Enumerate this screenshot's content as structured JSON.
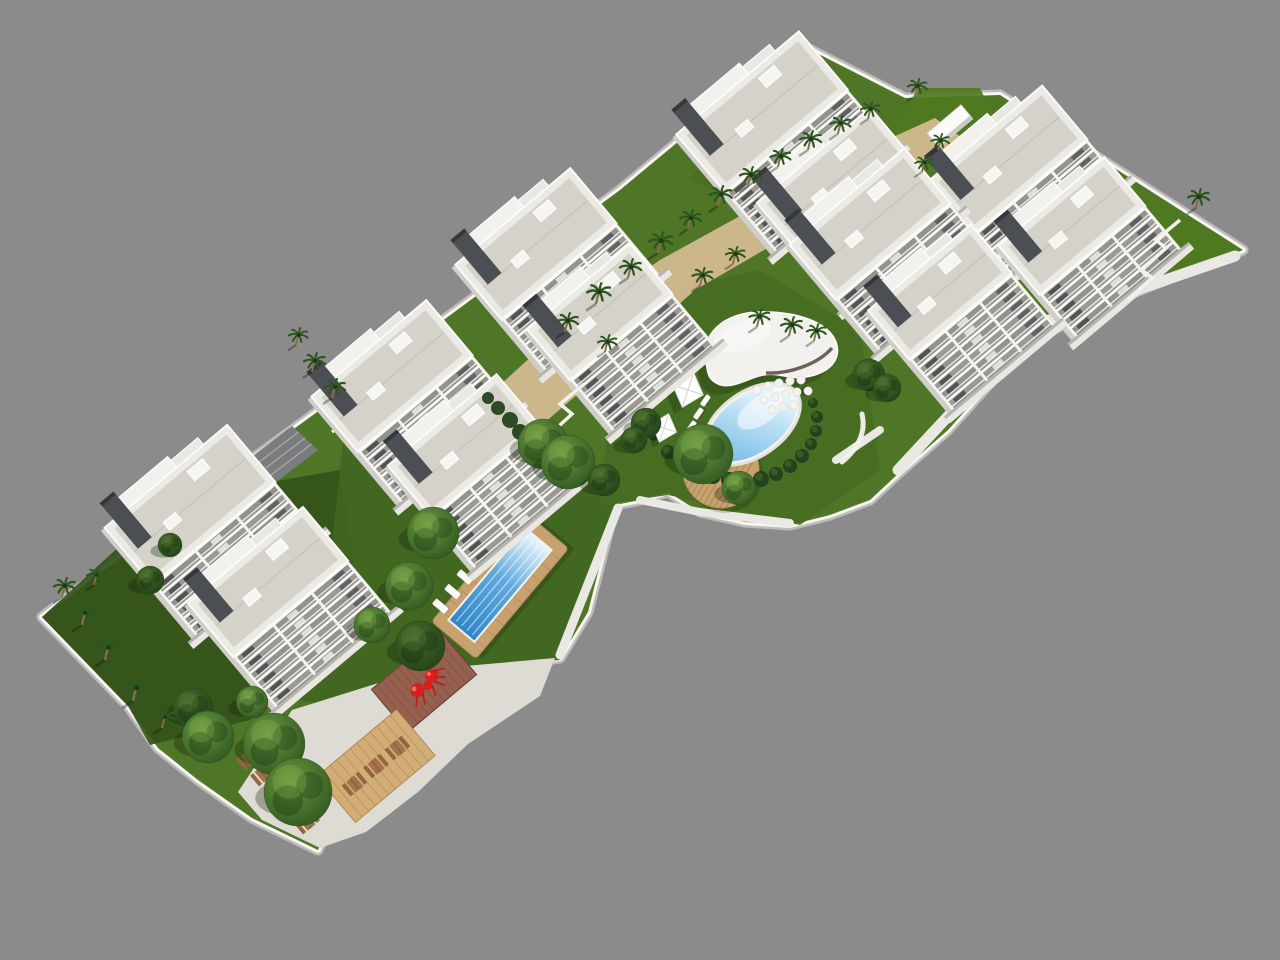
{
  "palette": {
    "bg": "#8b8b8b",
    "plotBase": "#e7e5e0",
    "wallTop": "#f6f5f1",
    "wallSide": "#bdbcb8",
    "lawnBase": "#49701f",
    "lawnDark": "#33531a",
    "lawnMid": "#41661f",
    "lawnAmenity": "#456d22",
    "lawnBright": "#4f7a1f",
    "sand": "#d2ba8e",
    "plaza": "#dddbd3",
    "walkway": "#e9e8e3",
    "ramp": "#6f7072",
    "ramp2": "#7b7c7e",
    "deckWood": "#c7a26f",
    "platformWood": "#d2ad76",
    "poolDeep": "#2e86c8",
    "poolLight": "#eaf7fd",
    "coping": "#f4f2ee",
    "hedge": "#24421c",
    "treeEdge": "#2f5420",
    "treeCore": "#6a9a3f",
    "palmFrond": "#2e5621",
    "trunk": "#8a6b4a",
    "red": "#d81f1f",
    "redDark": "#c01818",
    "paver": "#96604f",
    "facadeRecess": "#97968f",
    "sideShade": "#cfcec9",
    "roofTop": "#eceae5",
    "roofGravel": "#d5d2c9",
    "core": "#4b4e52",
    "pavement": "#e8e7e2",
    "boxWhite": "#fafaf7",
    "tableWood": "#a3714a",
    "benchWood": "#946540",
    "umbrella": "#fdfdfc"
  },
  "scene": {
    "canvas": {
      "w": 1280,
      "h": 960
    },
    "plot_outline": [
      [
        42,
        617
      ],
      [
        240,
        468
      ],
      [
        430,
        330
      ],
      [
        620,
        190
      ],
      [
        755,
        78
      ],
      [
        795,
        42
      ],
      [
        905,
        98
      ],
      [
        1000,
        95
      ],
      [
        1243,
        250
      ],
      [
        1120,
        298
      ],
      [
        1052,
        330
      ],
      [
        1000,
        372
      ],
      [
        948,
        430
      ],
      [
        900,
        472
      ],
      [
        870,
        500
      ],
      [
        830,
        515
      ],
      [
        790,
        525
      ],
      [
        745,
        522
      ],
      [
        700,
        512
      ],
      [
        668,
        492
      ],
      [
        640,
        500
      ],
      [
        615,
        505
      ],
      [
        588,
        612
      ],
      [
        560,
        658
      ],
      [
        423,
        675
      ],
      [
        383,
        715
      ],
      [
        358,
        782
      ],
      [
        332,
        818
      ],
      [
        318,
        850
      ],
      [
        252,
        818
      ],
      [
        198,
        780
      ],
      [
        158,
        748
      ],
      [
        128,
        706
      ]
    ],
    "lawn_patches": [
      {
        "pts": [
          [
            42,
            617
          ],
          [
            170,
            500
          ],
          [
            340,
            470
          ],
          [
            360,
            600
          ],
          [
            250,
            720
          ],
          [
            150,
            745
          ],
          [
            128,
            706
          ]
        ],
        "key": "lawnDark"
      },
      {
        "pts": [
          [
            330,
            560
          ],
          [
            350,
            380
          ],
          [
            520,
            430
          ],
          [
            620,
            500
          ],
          [
            560,
            660
          ],
          [
            430,
            672
          ],
          [
            383,
            715
          ],
          [
            300,
            700
          ]
        ],
        "key": "lawnMid"
      },
      {
        "pts": [
          [
            600,
            505
          ],
          [
            620,
            300
          ],
          [
            760,
            270
          ],
          [
            860,
            330
          ],
          [
            880,
            470
          ],
          [
            800,
            525
          ],
          [
            668,
            495
          ]
        ],
        "key": "lawnAmenity"
      },
      {
        "pts": [
          [
            940,
            300
          ],
          [
            990,
            185
          ],
          [
            1010,
            110
          ],
          [
            1238,
            248
          ],
          [
            1120,
            300
          ],
          [
            1046,
            332
          ],
          [
            996,
            368
          ],
          [
            950,
            340
          ]
        ],
        "key": "lawnBright"
      },
      {
        "pts": [
          [
            690,
            180
          ],
          [
            730,
            120
          ],
          [
            762,
            96
          ],
          [
            768,
            150
          ],
          [
            726,
            196
          ]
        ],
        "key": "lawnBase"
      },
      {
        "pts": [
          [
            880,
            150
          ],
          [
            920,
            88
          ],
          [
            980,
            88
          ],
          [
            1000,
            130
          ],
          [
            940,
            172
          ]
        ],
        "key": "lawnBright"
      }
    ],
    "sand_path": [
      [
        475,
        408
      ],
      [
        560,
        330
      ],
      [
        660,
        260
      ],
      [
        760,
        205
      ],
      [
        860,
        152
      ],
      [
        935,
        118
      ],
      [
        965,
        140
      ],
      [
        880,
        190
      ],
      [
        790,
        235
      ],
      [
        695,
        290
      ],
      [
        600,
        375
      ],
      [
        515,
        448
      ]
    ],
    "plaza": [
      [
        292,
        710
      ],
      [
        420,
        670
      ],
      [
        555,
        658
      ],
      [
        540,
        696
      ],
      [
        468,
        744
      ],
      [
        418,
        792
      ],
      [
        366,
        832
      ],
      [
        320,
        848
      ],
      [
        262,
        820
      ],
      [
        238,
        792
      ]
    ],
    "walkways": [
      {
        "d": "M 560 655 L 618 508",
        "w": 9
      },
      {
        "d": "M 470 562 L 568 468",
        "w": 10
      },
      {
        "d": "M 898 470 L 1032 326 L 1235 256",
        "w": 11
      },
      {
        "d": "M 640 500 L 700 512 L 790 523",
        "w": 8
      },
      {
        "d": "M 836 460 L 880 430",
        "w": 8
      }
    ],
    "planter_walls": [
      {
        "d": "M 150 520 L 192 488 L 214 510 L 252 482",
        "w": 3
      },
      {
        "d": "M 332 432 L 372 402 L 392 422 L 430 394",
        "w": 3
      }
    ],
    "zigzag_paths": [
      {
        "d": "M 1128 300 L 1152 278 L 1142 270 L 1166 248 L 1156 240 L 1180 220",
        "w": 3.5
      },
      {
        "d": "M 536 468 L 560 446 L 548 436 L 572 414 L 560 404 L 584 384",
        "w": 3.5
      }
    ],
    "ramps": [
      {
        "pts": [
          [
            356,
            392
          ],
          [
            418,
            344
          ],
          [
            452,
            372
          ],
          [
            390,
            420
          ]
        ],
        "key": "ramp"
      },
      {
        "pts": [
          [
            232,
            472
          ],
          [
            292,
            426
          ],
          [
            318,
            450
          ],
          [
            258,
            496
          ]
        ],
        "key": "ramp2"
      }
    ],
    "buildings": [
      {
        "x": 762,
        "y": 112,
        "w": 160,
        "d": 76,
        "floors": 7
      },
      {
        "x": 1008,
        "y": 160,
        "w": 148,
        "d": 70,
        "floors": 5
      },
      {
        "x": 836,
        "y": 182,
        "w": 148,
        "d": 70,
        "floors": 6
      },
      {
        "x": 870,
        "y": 224,
        "w": 150,
        "d": 72,
        "floors": 6
      },
      {
        "x": 1072,
        "y": 226,
        "w": 138,
        "d": 64,
        "floors": 5
      },
      {
        "x": 536,
        "y": 244,
        "w": 150,
        "d": 72,
        "floors": 6
      },
      {
        "x": 940,
        "y": 292,
        "w": 134,
        "d": 64,
        "floors": 6
      },
      {
        "x": 600,
        "y": 312,
        "w": 134,
        "d": 66,
        "floors": 6
      },
      {
        "x": 392,
        "y": 376,
        "w": 150,
        "d": 72,
        "floors": 6
      },
      {
        "x": 464,
        "y": 446,
        "w": 142,
        "d": 68,
        "floors": 6
      },
      {
        "x": 190,
        "y": 505,
        "w": 160,
        "d": 75,
        "floors": 6
      },
      {
        "x": 268,
        "y": 582,
        "w": 150,
        "d": 70,
        "floors": 6
      }
    ],
    "lap_pool": {
      "x": 500,
      "y": 585,
      "rot": -50,
      "deck_w": 144,
      "deck_h": 58,
      "pool_w": 120,
      "pool_h": 34,
      "lounger_count": 6
    },
    "oval_pool": {
      "x": 752,
      "y": 424,
      "rot": -35,
      "rx": 52,
      "ry": 30
    },
    "oval_loungers": [
      {
        "x": 700,
        "y": 404
      },
      {
        "x": 693,
        "y": 417
      },
      {
        "x": 686,
        "y": 430
      },
      {
        "x": 680,
        "y": 443
      },
      {
        "x": 674,
        "y": 455
      }
    ],
    "hedges": [
      [
        668,
        452,
        7
      ],
      [
        682,
        462,
        7
      ],
      [
        697,
        470,
        8
      ],
      [
        713,
        476,
        8
      ],
      [
        729,
        480,
        8
      ],
      [
        745,
        481,
        8
      ],
      [
        761,
        479,
        8
      ],
      [
        776,
        474,
        7
      ],
      [
        790,
        466,
        7
      ],
      [
        802,
        456,
        7
      ],
      [
        811,
        444,
        6
      ],
      [
        816,
        431,
        6
      ],
      [
        817,
        417,
        6
      ],
      [
        813,
        403,
        5
      ],
      [
        806,
        391,
        5
      ],
      [
        654,
        436,
        5
      ],
      [
        648,
        425,
        4
      ]
    ],
    "stepping_stones": {
      "r": 4.2,
      "pts": [
        [
          757,
          390
        ],
        [
          768,
          386
        ],
        [
          779,
          383
        ],
        [
          790,
          381
        ],
        [
          801,
          380
        ],
        [
          764,
          400
        ],
        [
          775,
          397
        ],
        [
          786,
          394
        ],
        [
          797,
          392
        ],
        [
          808,
          391
        ],
        [
          772,
          410
        ],
        [
          783,
          407
        ],
        [
          794,
          405
        ]
      ]
    },
    "clubhouse": {
      "roof": "M 706 362 C 700 334, 724 313, 758 312 C 794 311, 828 321, 836 342 C 842 359, 830 373, 806 377 C 790 380, 779 372, 763 375 C 747 378, 733 390, 718 384 C 707 379, 708 372, 706 362 Z",
      "glass": "M 766 373 C 790 374, 818 364, 832 348",
      "floor": "M 770 372 C 792 372, 816 363, 830 349 L 836 342 C 828 324, 794 312, 770 313 Z"
    },
    "round_deck": {
      "x": 721,
      "y": 470,
      "r": 38
    },
    "sculpture_plaza": {
      "x": 424,
      "y": 682,
      "w": 90,
      "h": 56,
      "rot": -40
    },
    "picnic_platform": {
      "x": 376,
      "y": 766,
      "w": 104,
      "h": 60,
      "rot": -40,
      "table_offsets": [
        -28,
        0,
        28
      ]
    },
    "free_tables": [
      {
        "x": 249,
        "y": 758
      },
      {
        "x": 263,
        "y": 774
      },
      {
        "x": 318,
        "y": 790
      },
      {
        "x": 307,
        "y": 822
      }
    ],
    "umbrellas": [
      {
        "x": 688,
        "y": 390,
        "s": 1.15
      },
      {
        "x": 664,
        "y": 428,
        "s": 0.95
      }
    ],
    "bench_arc": "M 842 462 Q 868 440 862 414",
    "utility_box": {
      "x": 950,
      "y": 126,
      "w": 44,
      "h": 18,
      "rot": -40
    },
    "trees": [
      [
        193,
        708,
        20,
        1
      ],
      [
        208,
        737,
        26,
        0
      ],
      [
        274,
        744,
        31,
        0
      ],
      [
        298,
        792,
        34,
        0
      ],
      [
        252,
        702,
        16,
        0
      ],
      [
        150,
        580,
        14,
        1
      ],
      [
        170,
        545,
        12,
        1
      ],
      [
        420,
        646,
        25,
        1
      ],
      [
        433,
        533,
        26,
        0
      ],
      [
        409,
        586,
        24,
        0
      ],
      [
        372,
        625,
        18,
        0
      ],
      [
        543,
        444,
        25,
        0
      ],
      [
        568,
        462,
        27,
        0
      ],
      [
        604,
        480,
        16,
        1
      ],
      [
        703,
        454,
        30,
        0
      ],
      [
        739,
        488,
        17,
        0
      ],
      [
        646,
        423,
        15,
        1
      ],
      [
        634,
        440,
        13,
        1
      ],
      [
        869,
        375,
        16,
        1
      ],
      [
        887,
        388,
        14,
        1
      ]
    ],
    "shrubs": [
      [
        510,
        420,
        8
      ],
      [
        520,
        432,
        8
      ],
      [
        531,
        444,
        8
      ],
      [
        498,
        408,
        7
      ],
      [
        488,
        398,
        6
      ]
    ],
    "palms": [
      [
        62,
        597,
        1
      ],
      [
        82,
        625,
        1.1
      ],
      [
        105,
        660,
        1.15
      ],
      [
        133,
        701,
        1.2
      ],
      [
        162,
        728,
        1
      ],
      [
        94,
        585,
        0.9
      ],
      [
        296,
        345,
        0.9
      ],
      [
        312,
        372,
        1
      ],
      [
        332,
        398,
        1
      ],
      [
        565,
        332,
        1
      ],
      [
        596,
        304,
        1.1
      ],
      [
        628,
        278,
        1
      ],
      [
        658,
        253,
        1.1
      ],
      [
        688,
        229,
        1
      ],
      [
        718,
        206,
        1.05
      ],
      [
        748,
        186,
        1
      ],
      [
        778,
        167,
        0.95
      ],
      [
        808,
        150,
        1
      ],
      [
        838,
        134,
        0.95
      ],
      [
        868,
        119,
        0.9
      ],
      [
        700,
        286,
        0.95
      ],
      [
        733,
        264,
        0.9
      ],
      [
        605,
        352,
        0.9
      ],
      [
        915,
        96,
        0.9
      ],
      [
        938,
        150,
        0.85
      ],
      [
        922,
        172,
        0.85
      ],
      [
        757,
        327,
        0.95
      ],
      [
        789,
        336,
        1
      ],
      [
        814,
        341,
        0.9
      ],
      [
        1196,
        208,
        1
      ]
    ]
  }
}
